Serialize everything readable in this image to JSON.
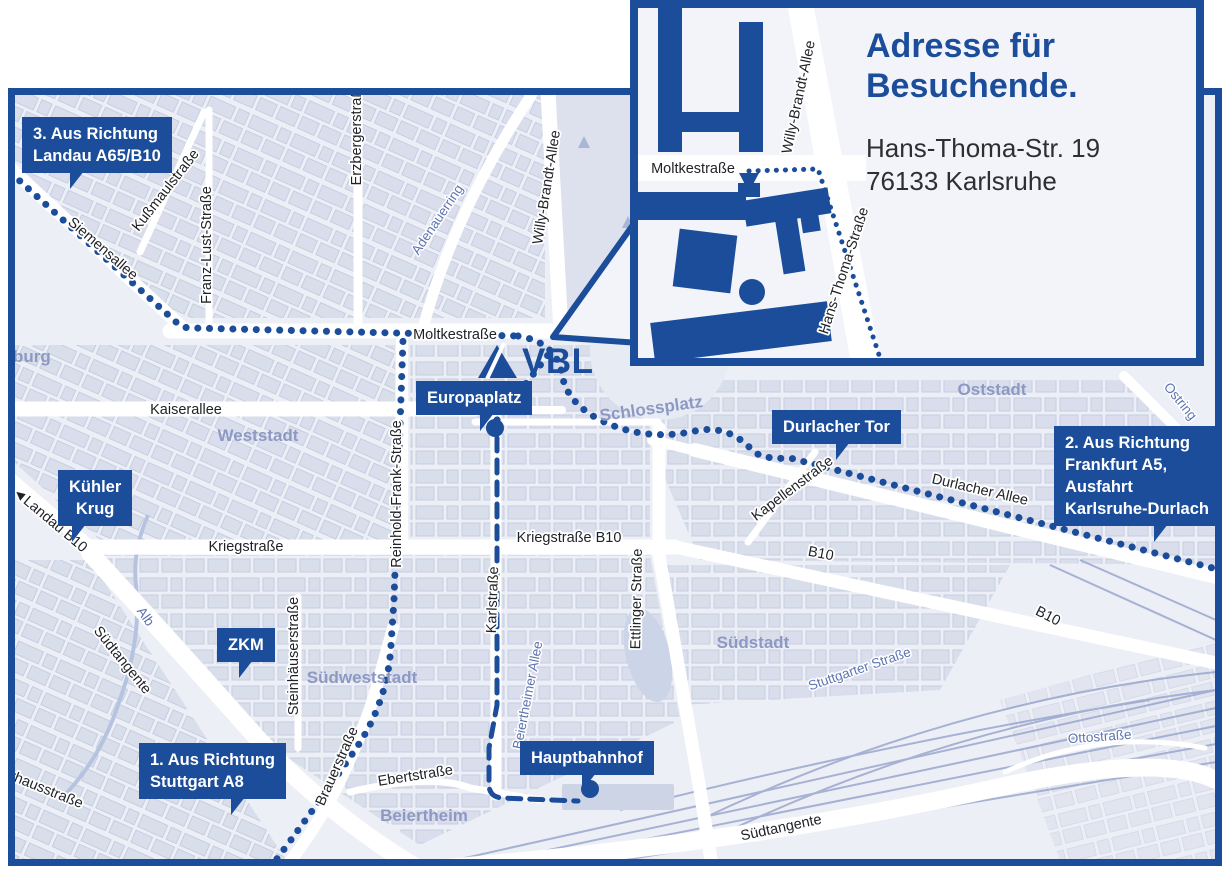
{
  "inset": {
    "title_line1": "Adresse für",
    "title_line2": "Besuchende.",
    "address_line1": "Hans-Thoma-Str. 19",
    "address_line2": "76133 Karlsruhe",
    "streets": {
      "hans_thoma_strasse": "Hans-Thoma-Straße"
    }
  },
  "logo": {
    "text": "VBL"
  },
  "callouts": {
    "landau": {
      "line1": "3. Aus Richtung",
      "line2": "Landau A65/B10"
    },
    "kuehler_krug": {
      "line1": "Kühler",
      "line2": "Krug"
    },
    "zkm": {
      "line1": "ZKM"
    },
    "stuttgart": {
      "line1": "1. Aus Richtung",
      "line2": "Stuttgart A8"
    },
    "europaplatz": {
      "line1": "Europaplatz"
    },
    "durlacher_tor": {
      "line1": "Durlacher Tor"
    },
    "frankfurt": {
      "line1": "2. Aus Richtung",
      "line2": "Frankfurt A5,",
      "line3": "Ausfahrt",
      "line4": "Karlsruhe-Durlach"
    },
    "hauptbahnhof": {
      "line1": "Hauptbahnhof"
    }
  },
  "streets": {
    "siemensallee": "Siemensallee",
    "kussmaulstrasse": "Kußmaulstraße",
    "franz_lust_strasse": "Franz-Lust-Straße",
    "erzbergerstrasse": "Erzbergerstraße",
    "willy_brandt_allee": "Willy-Brandt-Allee",
    "moltkestrasse": "Moltkestraße",
    "kaiserallee": "Kaiserallee",
    "kriegstrasse": "Kriegstraße",
    "kriegstrasse_b10": "Kriegstraße B10",
    "reinhold_frank_strasse": "Reinhold-Frank-Straße",
    "karlstrasse": "Karlstraße",
    "ettlinger_strasse": "Ettlinger Straße",
    "durlacher_allee": "Durlacher Allee",
    "kapellenstrasse": "Kapellenstraße",
    "b10": "B10",
    "landau_b10": "◄Landau B10",
    "suedtangente": "Südtangente",
    "brauerstrasse": "Brauerstraße",
    "steinhaeuserstrasse": "Steinhäuserstraße",
    "ebertstrasse": "Ebertstraße",
    "pulverhausstrasse": "Pulverhausstraße",
    "ottostrasse": "Ottostraße",
    "ostring": "Ostring",
    "adenauerring": "Adenauerring",
    "alb": "Alb",
    "beiertheimer_allee": "Beiertheimer Allee",
    "stuttgarter_strasse": "Stuttgarter Straße"
  },
  "districts": {
    "muehlburg": "Mühlburg",
    "weststadt": "Weststadt",
    "oststadt": "Oststadt",
    "suedstadt": "Südstadt",
    "suedweststadt": "Südweststadt",
    "beiertheim": "Beiertheim",
    "schlossplatz": "Schlossplatz"
  },
  "colors": {
    "brand_blue": "#1b4d9b",
    "map_background": "#edeff6",
    "block_fill": "#d8ddeb",
    "district_label": "#8d99c3",
    "blue_street_label": "#5d74af",
    "route_dots": "#1b4d9b",
    "railway": "#9aa7cd"
  }
}
